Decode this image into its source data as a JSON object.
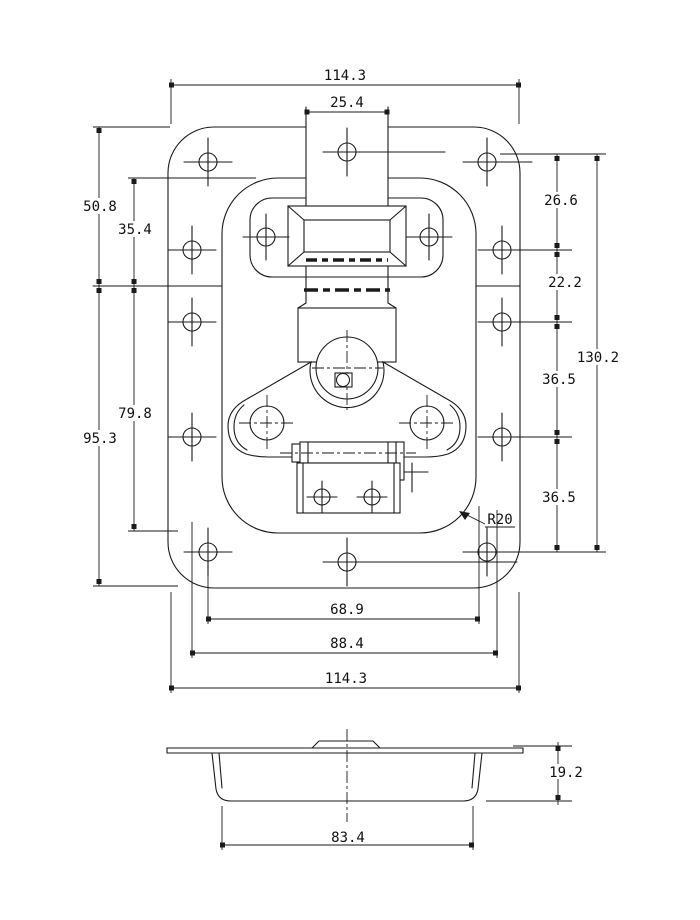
{
  "dimensions": {
    "top_overall_width": "114.3",
    "strap_width": "25.4",
    "left_edge_to_split": "50.8",
    "dish_top_to_split": "35.4",
    "split_to_plate_bottom": "95.3",
    "split_to_dish_bottom": "79.8",
    "hole_row_spacing_1": "26.6",
    "hole_row_spacing_2": "22.2",
    "hole_row_spacing_3": "36.5",
    "hole_row_spacing_4": "36.5",
    "hole_span_height": "130.2",
    "dish_corner_radius": "R20",
    "bottom_span_inner": "68.9",
    "bottom_span_mid": "88.4",
    "bottom_overall_width": "114.3",
    "recess_depth": "19.2",
    "recess_width": "83.4"
  }
}
